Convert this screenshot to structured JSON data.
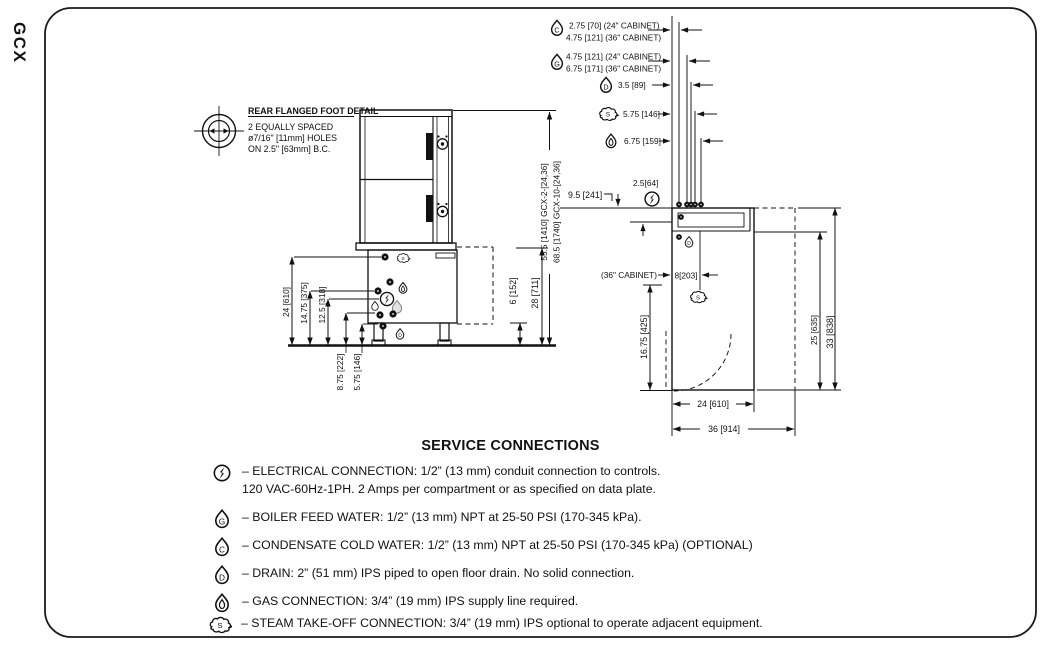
{
  "page": {
    "product_label": "GCX"
  },
  "foot_detail": {
    "title": "REAR FLANGED FOOT DETAIL",
    "lines": [
      "2 EQUALLY SPACED",
      "ø7/16\" [11mm] HOLES",
      "ON 2.5\" [63mm] B.C."
    ]
  },
  "front_view": {
    "left_dims": [
      "24 [610]",
      "14.75 [375]",
      "12.5 [318]",
      "8.75 [222]",
      "5.75 [146]"
    ],
    "right_dims": [
      "6 [152]",
      "28 [711]"
    ],
    "height_dims": [
      "55.5 [1410] GCX-2-[24,36]",
      "68.5 [1740] GCX-10-[24,36]"
    ]
  },
  "plan_view": {
    "top_dims": [
      {
        "icon": "condensate-drop-icon",
        "lines": [
          "2.75 [70] (24\" CABINET)",
          "4.75 [121] (36\" CABINET)"
        ]
      },
      {
        "icon": "boiler-feed-drop-icon",
        "lines": [
          "4.75 [121] (24\" CABINET)",
          "6.75 [171] (36\" CABINET)"
        ]
      },
      {
        "icon": "drain-drop-icon",
        "lines": [
          "3.5 [89]"
        ]
      },
      {
        "icon": "steam-cloud-icon",
        "lines": [
          "5.75 [146]"
        ]
      },
      {
        "icon": "gas-flame-icon",
        "lines": [
          "6.75 [159]"
        ]
      }
    ],
    "left_offset": "9.5 [241]",
    "electrical_offset": "2.5[64]",
    "cabinet_note": "(36\" CABINET)",
    "steam_offset": "8[203]",
    "right_dims": [
      "25 [635]",
      "33 [838]"
    ],
    "front_offset": "16.75 [425]",
    "bottom_dims": [
      "24 [610]",
      "36 [914]"
    ]
  },
  "service_connections": {
    "title": "SERVICE CONNECTIONS",
    "items": [
      {
        "icon": "electrical-icon",
        "lines": [
          "– ELECTRICAL CONNECTION: 1/2” (13 mm) conduit connection to controls.",
          "120 VAC-60Hz-1PH.  2 Amps per compartment or as specified on data plate."
        ]
      },
      {
        "icon": "boiler-feed-drop-icon",
        "lines": [
          "– BOILER FEED WATER: 1/2” (13 mm) NPT at 25-50 PSI (170-345 kPa)."
        ]
      },
      {
        "icon": "condensate-drop-icon",
        "lines": [
          "– CONDENSATE COLD WATER: 1/2” (13 mm) NPT at 25-50 PSI (170-345 kPa) (OPTIONAL)"
        ]
      },
      {
        "icon": "drain-drop-icon",
        "lines": [
          "– DRAIN: 2” (51 mm) IPS piped to open floor drain. No solid connection."
        ]
      },
      {
        "icon": "gas-flame-icon",
        "lines": [
          "– GAS CONNECTION: 3/4” (19 mm) IPS supply line required."
        ]
      },
      {
        "icon": "steam-cloud-icon",
        "lines": [
          "– STEAM TAKE-OFF CONNECTION: 3/4” (19 mm) IPS optional to operate adjacent equipment."
        ]
      }
    ]
  }
}
